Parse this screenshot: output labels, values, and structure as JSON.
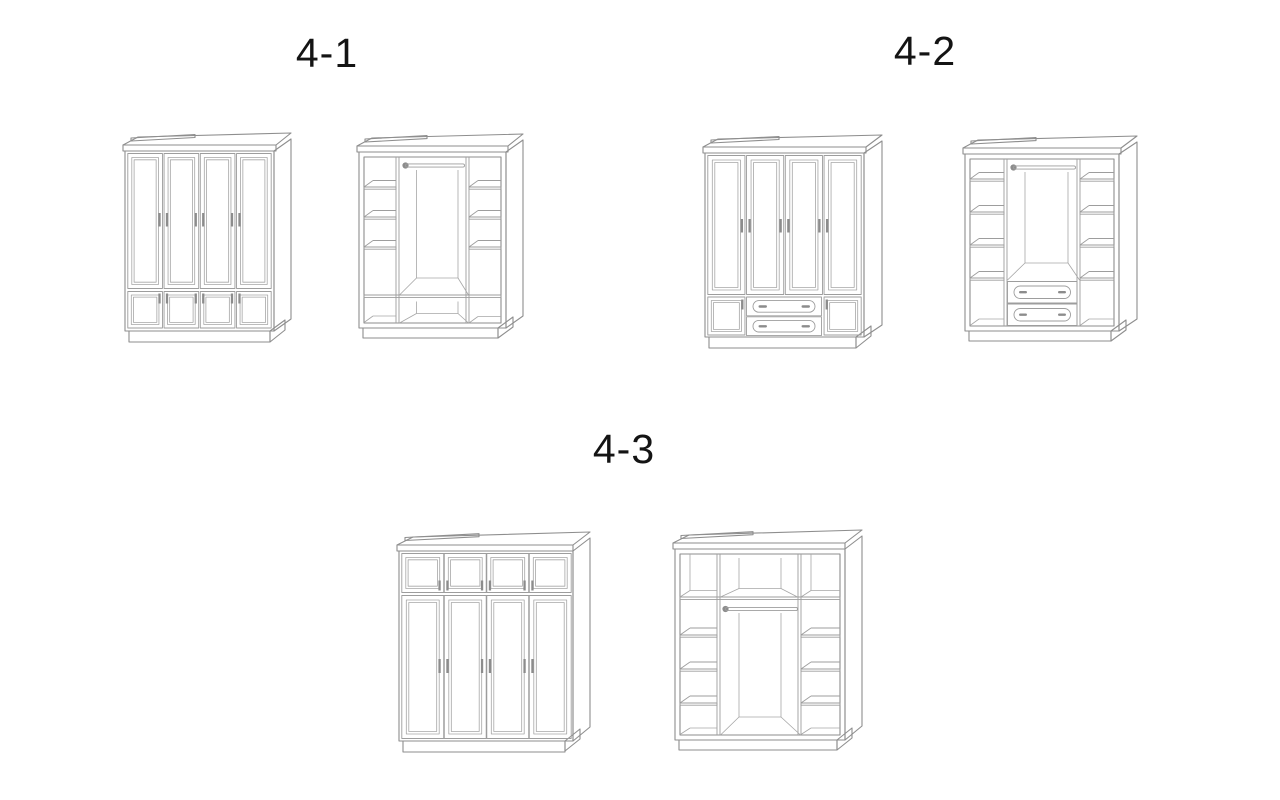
{
  "page": {
    "background_color": "#ffffff",
    "line_color": "#8e8e8e",
    "detail_line_color": "#9d9d9d",
    "handle_color": "#8c8c8c",
    "label_color": "#141414"
  },
  "figures": [
    {
      "label": "4-1"
    },
    {
      "label": "4-2"
    },
    {
      "label": "4-3"
    }
  ]
}
